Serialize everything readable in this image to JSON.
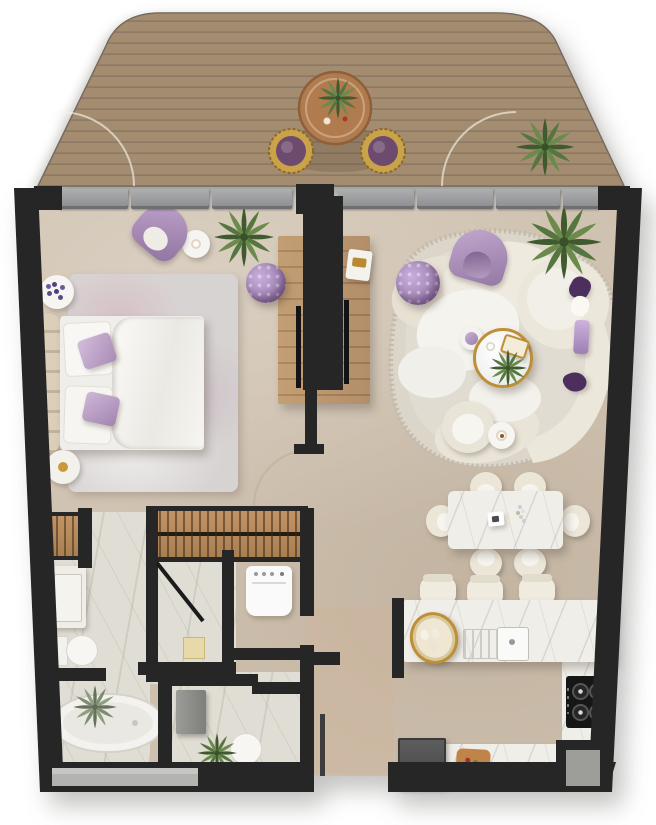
{
  "scene": {
    "kind": "top-down 3D floor plan rendering",
    "rooms_visible": 8
  },
  "palette": {
    "wall": "#262626",
    "floor": "#cfc1af",
    "marble": "#e0ddd4",
    "counter": "#f0eee8",
    "deck-wood": "#9a8164",
    "deck-line": "#826c55",
    "closet-wood": "#b5885a",
    "window-gray": "#8f9092",
    "glass": "#b3b4b0",
    "cream": "#ebe6da",
    "cream-light": "#f5f3ee",
    "white": "#f6f5f2",
    "purple": "#8f72a0",
    "lilac": "#b99cc4",
    "lilac-light": "#c9aede",
    "purple-deep": "#4d2f5e",
    "plum": "#6d4b6e",
    "gold": "#bd8f36",
    "green": "#55763f",
    "green-dark": "#3f5a2e",
    "rug-bed": "#d8d3d3",
    "rug-living": "#dbd5ca",
    "headboard-tan": "#d7c9b3"
  },
  "terrace": {
    "floor": "wood-plank-deck",
    "items": [
      "round-bistro-table",
      "table-plant",
      "purple-stool-left",
      "purple-stool-right",
      "potted-plant",
      "door-swing-arc-left",
      "door-swing-arc-right"
    ]
  },
  "window_wall": {
    "style": "sliding-glass-segments",
    "segment_count": 7,
    "pillar": "center-column"
  },
  "bedroom": {
    "items": [
      "double-bed",
      "white-duvet",
      "white-pillows",
      "purple-accent-pillows",
      "tufted-headboard-bench",
      "area-rug",
      "purple-tub-armchair",
      "round-side-table-with-coffee",
      "lavender-decor-plate",
      "round-nightstand",
      "potted-plant",
      "purple-tufted-pouf"
    ]
  },
  "media_wall": {
    "items": [
      "wood-low-console",
      "double-sided-tv-partition",
      "tv-screen-bedroom-side",
      "tv-screen-living-side",
      "decor-tray"
    ]
  },
  "living_room": {
    "items": [
      "organic-shaped-rug",
      "curved-modular-sofa",
      "round-daybed-module",
      "purple-arch-armchair",
      "purple-tufted-pouf",
      "round-coffee-table-gold-rim",
      "coffee-table-greenery",
      "lilac-side-table",
      "cream-armchair",
      "round-side-table-with-coffee",
      "palm-plant",
      "purple-throw",
      "deep-purple-pillows"
    ]
  },
  "dining_area": {
    "items": [
      "marble-dining-table",
      "dining-chairs",
      "decor-plate",
      "flower-stem"
    ],
    "chair_count": 6
  },
  "kitchen": {
    "items": [
      "marble-island-counter",
      "bar-stools",
      "gold-oval-tray",
      "double-sink-with-faucet",
      "right-run-counter",
      "gas-cooktop-4-burner",
      "lower-counter",
      "food-board",
      "dark-refrigerator-cabinet",
      "appliance-niche"
    ],
    "stool_count": 3,
    "burner_count": 4
  },
  "bathroom": {
    "items": [
      "hanging-closet-small",
      "walk-in-wardrobe-double-rail",
      "vanity-with-basin",
      "toilet",
      "freestanding-oval-bathtub",
      "bath-plant",
      "frosted-window-strip",
      "shower-room",
      "shower-glass-door",
      "floor-drain"
    ]
  },
  "laundry_nook": {
    "items": [
      "washing-machine"
    ]
  },
  "wc": {
    "items": [
      "gray-vanity-cabinet",
      "toilet",
      "potted-plant"
    ]
  },
  "entry": {
    "items": [
      "entry-door-leaf",
      "door-opening"
    ]
  }
}
